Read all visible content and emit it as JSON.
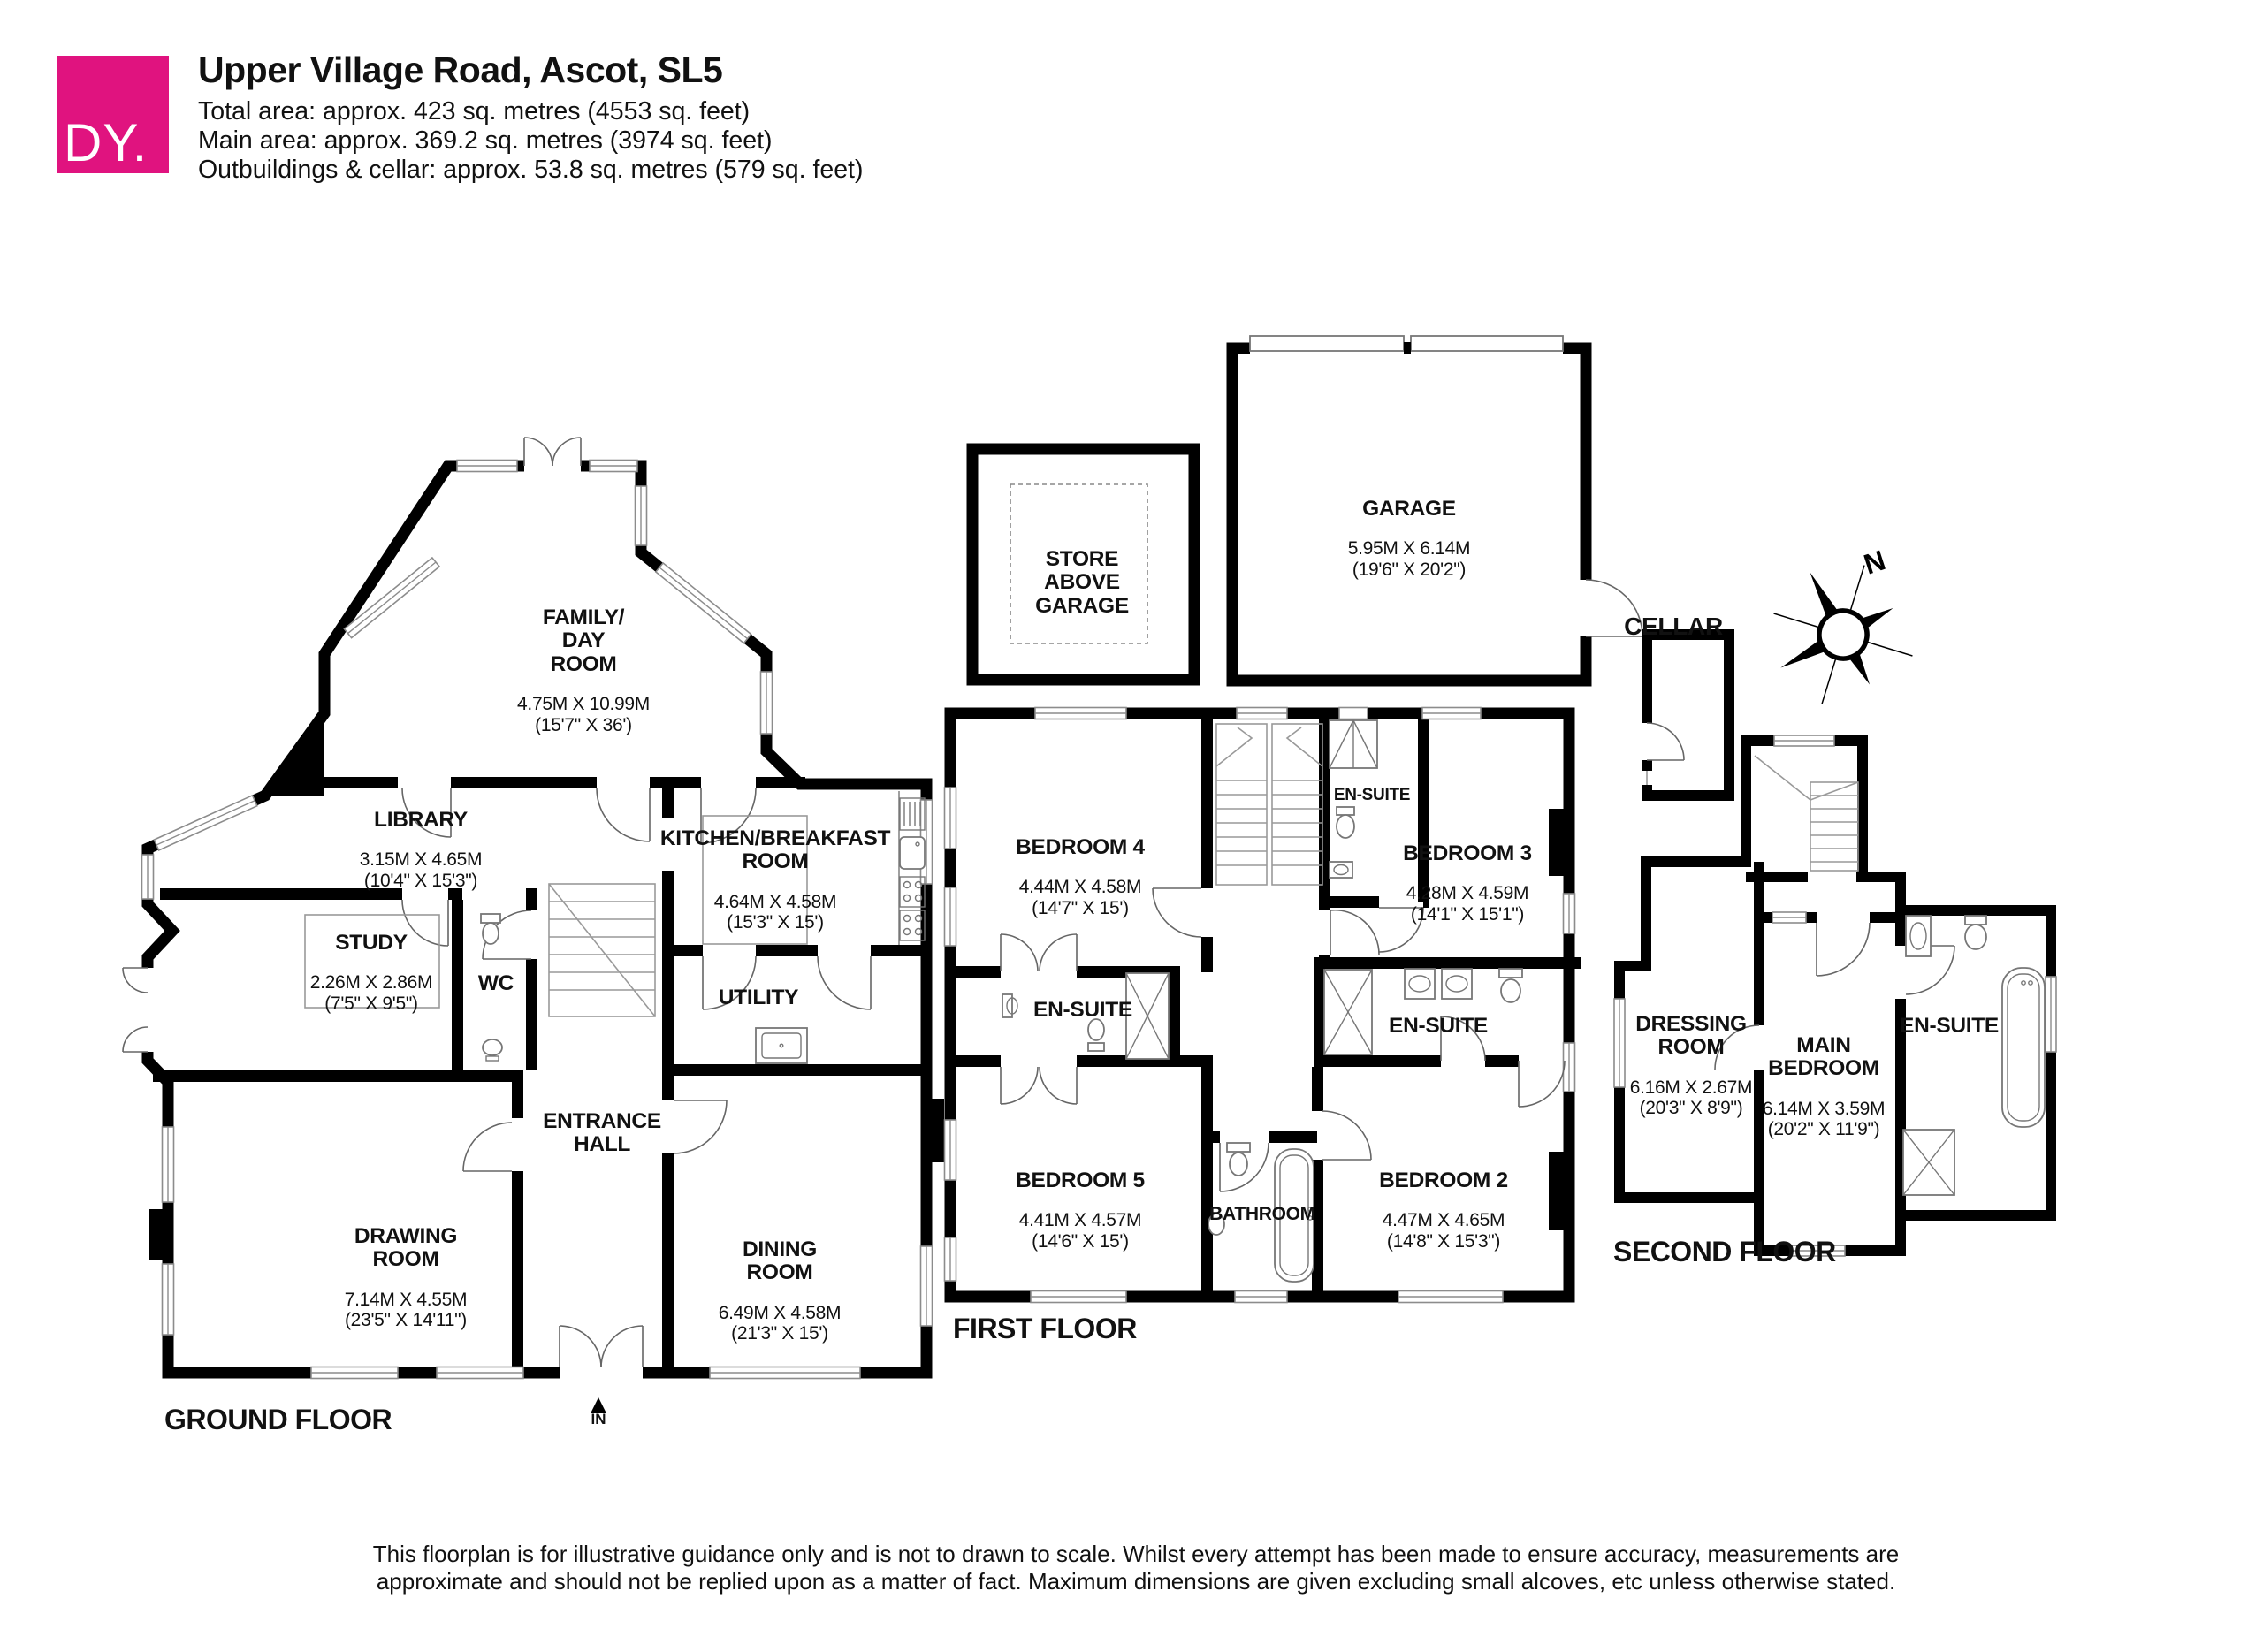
{
  "header": {
    "logo_text": "DY.",
    "title": "Upper Village Road, Ascot, SL5",
    "area_lines": "Total area: approx. 423 sq. metres (4553 sq. feet)\nMain area: approx. 369.2 sq. metres (3974 sq. feet)\nOutbuildings & cellar: approx. 53.8 sq. metres (579 sq. feet)",
    "brand_color": "#e0137f"
  },
  "ground": {
    "label": "GROUND FLOOR",
    "in_label": "IN",
    "family_name": "FAMILY/\nDAY\nROOM",
    "family_dims": "4.75M X 10.99M\n(15'7\" X 36')",
    "library_name": "LIBRARY",
    "library_dims": "3.15M X 4.65M\n(10'4\" X 15'3\")",
    "study_name": "STUDY",
    "study_dims": "2.26M X 2.86M\n(7'5\" X 9'5\")",
    "wc_name": "WC",
    "kitchen_name": "KITCHEN/BREAKFAST\nROOM",
    "kitchen_dims": "4.64M X 4.58M\n(15'3\" X 15')",
    "utility_name": "UTILITY",
    "hall_name": "ENTRANCE\nHALL",
    "drawing_name": "DRAWING\nROOM",
    "drawing_dims": "7.14M X 4.55M\n(23'5\" X 14'11\")",
    "dining_name": "DINING\nROOM",
    "dining_dims": "6.49M X 4.58M\n(21'3\" X 15')"
  },
  "first": {
    "label": "FIRST FLOOR",
    "bed4_name": "BEDROOM 4",
    "bed4_dims": "4.44M X 4.58M\n(14'7\" X 15')",
    "bed3_name": "BEDROOM 3",
    "bed3_dims": "4.28M X 4.59M\n(14'1\" X 15'1\")",
    "bed5_name": "BEDROOM 5",
    "bed5_dims": "4.41M X 4.57M\n(14'6\" X 15')",
    "bed2_name": "BEDROOM 2",
    "bed2_dims": "4.47M X 4.65M\n(14'8\" X 15'3\")",
    "ensuite_top": "EN-SUITE",
    "ensuite_left": "EN-SUITE",
    "ensuite_right": "EN-SUITE",
    "bathroom_name": "BATHROOM"
  },
  "second": {
    "label": "SECOND FLOOR",
    "dressing_name": "DRESSING\nROOM",
    "dressing_dims": "6.16M X 2.67M\n(20'3\" X 8'9\")",
    "main_name": "MAIN\nBEDROOM",
    "main_dims": "6.14M X 3.59M\n(20'2\" X 11'9\")",
    "ensuite_name": "EN-SUITE"
  },
  "outbuildings": {
    "garage_name": "GARAGE",
    "garage_dims": "5.95M X 6.14M\n(19'6\" X 20'2\")",
    "store_name": "STORE\nABOVE\nGARAGE",
    "cellar_name": "CELLAR"
  },
  "compass": {
    "north_label": "N"
  },
  "footer": {
    "line1": "This floorplan is for illustrative guidance only and is not to drawn to scale. Whilst every attempt has been made to ensure accuracy, measurements are",
    "line2": "approximate and should not be replied upon as a matter of fact. Maximum dimensions are given excluding small alcoves, etc unless otherwise stated."
  }
}
